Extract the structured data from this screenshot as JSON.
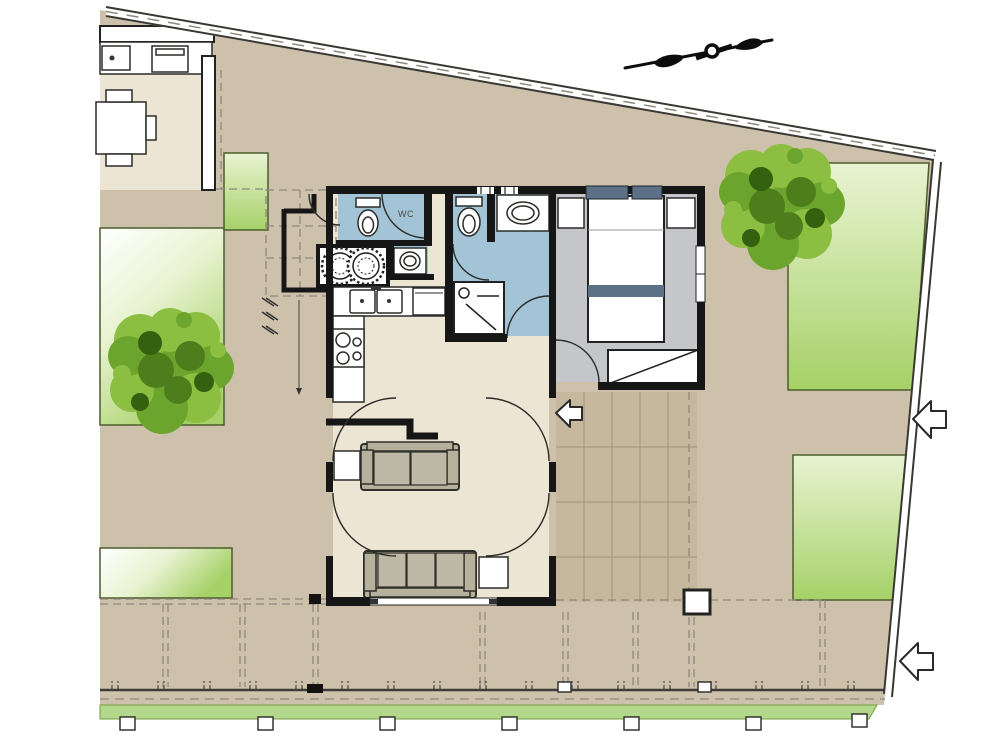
{
  "labels": {
    "wc": "WC"
  },
  "colors": {
    "ground": "#cdc1ac",
    "floor-cream": "#ede5d4",
    "floor-bath": "#a3c4d6",
    "floor-bedroom": "#c4c6c9",
    "terrace": "#c6b89f",
    "terrace-grid": "#a2937a",
    "lawn-pale": "#e9f3d2",
    "lawn-deep": "#a6d168",
    "lawn-border": "#4c5c2c",
    "hedge": "#b4d88b",
    "tree-light": "#8cbe41",
    "tree-mid": "#6ca52d",
    "tree-dark": "#4e7e1b",
    "tree-darkest": "#33610f",
    "sofa": "#b5b19c",
    "cushion": "#bdb9a6",
    "slate": "#5d7186",
    "wall": "#161616",
    "boundary": "#3a3833",
    "dash": "#8f897b"
  }
}
